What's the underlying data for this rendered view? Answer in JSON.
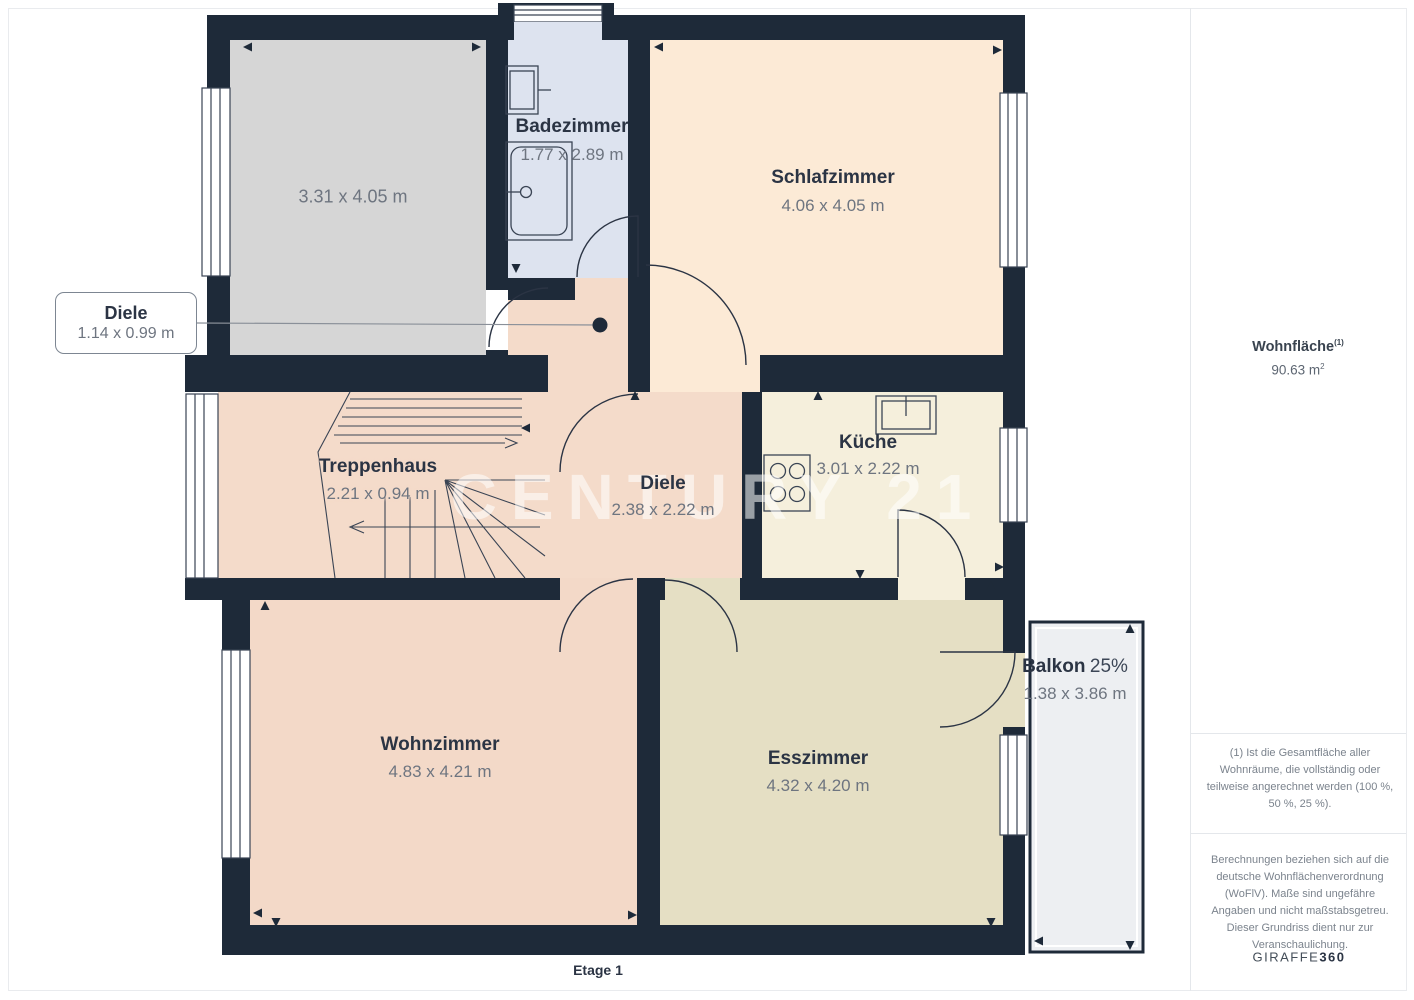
{
  "floor": {
    "label": "Etage 1"
  },
  "watermark": "CENTURY 21",
  "rooms": {
    "abstellraum": {
      "dims": "3.31 x 4.05 m"
    },
    "badezimmer": {
      "name": "Badezimmer",
      "dims": "1.77 x 2.89 m"
    },
    "schlafzimmer": {
      "name": "Schlafzimmer",
      "dims": "4.06 x 4.05 m"
    },
    "diele_klein": {
      "name": "Diele",
      "dims": "1.14 x 0.99 m"
    },
    "treppenhaus": {
      "name": "Treppenhaus",
      "dims": "2.21 x 0.94 m"
    },
    "diele": {
      "name": "Diele",
      "dims": "2.38 x 2.22 m"
    },
    "kueche": {
      "name": "Küche",
      "dims": "3.01 x 2.22 m"
    },
    "wohnzimmer": {
      "name": "Wohnzimmer",
      "dims": "4.83 x 4.21 m"
    },
    "esszimmer": {
      "name": "Esszimmer",
      "dims": "4.32 x 4.20 m"
    },
    "balkon": {
      "name": "Balkon",
      "percent": "25%",
      "dims": "1.38 x 3.86 m"
    }
  },
  "sidebar": {
    "area_label": "Wohnfläche",
    "area_label_sup": "(1)",
    "area_value": "90.63 m",
    "area_value_sup": "2",
    "footnote1": "(1) Ist die Gesamtfläche aller Wohnräume, die vollständig oder teilweise angerechnet werden (100 %, 50 %, 25 %).",
    "footnote2": "Berechnungen beziehen sich auf die deutsche Wohnflächenverordnung (WoFlV). Maße sind ungefähre Angaben und nicht maßstabsgetreu. Dieser Grundriss dient nur zur Veranschaulichung.",
    "brand": "GIRAFFE",
    "brand_suffix": "360"
  },
  "colors": {
    "wall": "#1e2a39",
    "room_gray": "#d6d6d6",
    "room_bath": "#dde3ef",
    "room_schlaf": "#fcead6",
    "room_pink": "#f4dbca",
    "room_kueche": "#f5efdc",
    "room_ess": "#e5dfc4",
    "balkon": "#edeff2"
  }
}
